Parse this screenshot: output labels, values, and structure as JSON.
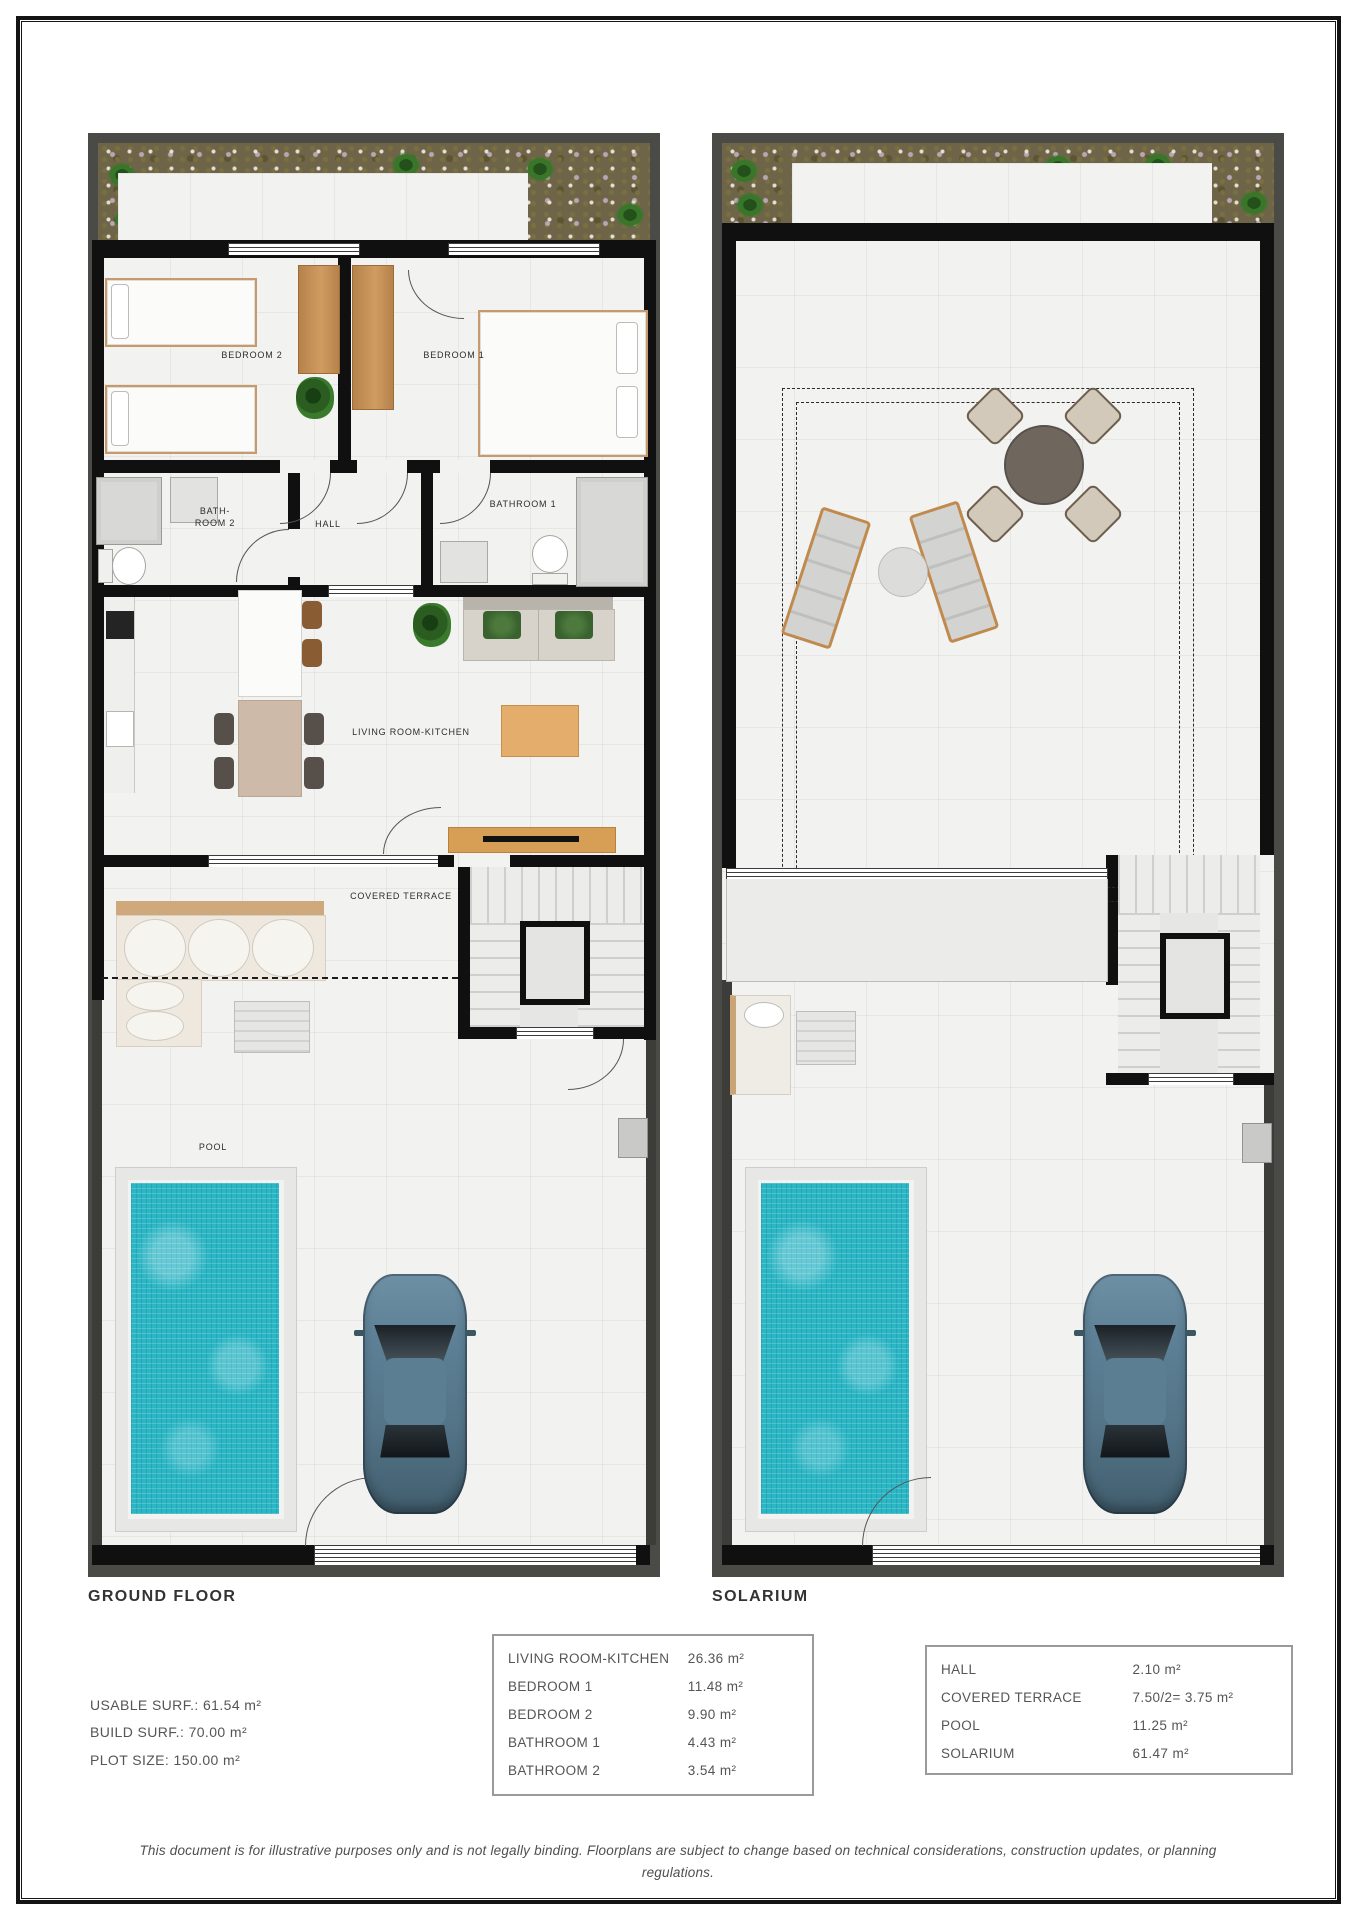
{
  "document": {
    "disclaimer": "This document is for illustrative purposes only and is not legally binding. Floorplans are subject to change based on technical considerations, construction updates, or planning regulations."
  },
  "plans": {
    "ground_floor": {
      "title": "GROUND FLOOR",
      "labels": {
        "bedroom2": "BEDROOM 2",
        "bedroom1": "BEDROOM 1",
        "bathroom2": "BATH-\nROOM 2",
        "hall": "HALL",
        "bathroom1": "BATHROOM 1",
        "living": "LIVING ROOM-KITCHEN",
        "terrace": "COVERED TERRACE",
        "pool": "POOL"
      }
    },
    "solarium": {
      "title": "SOLARIUM"
    }
  },
  "surface_summary": {
    "rows": [
      {
        "label": "USABLE SURF.:",
        "value": "61.54 m²"
      },
      {
        "label": "BUILD SURF.:",
        "value": "70.00 m²"
      },
      {
        "label": "PLOT SIZE:",
        "value": "150.00 m²"
      }
    ]
  },
  "room_areas_table": {
    "rows": [
      {
        "name": "LIVING ROOM-KITCHEN",
        "value": "26.36 m²"
      },
      {
        "name": "BEDROOM 1",
        "value": "11.48 m²"
      },
      {
        "name": "BEDROOM 2",
        "value": "9.90 m²"
      },
      {
        "name": "BATHROOM 1",
        "value": "4.43 m²"
      },
      {
        "name": "BATHROOM 2",
        "value": "3.54 m²"
      }
    ]
  },
  "exterior_areas_table": {
    "rows": [
      {
        "name": "HALL",
        "value": "2.10 m²"
      },
      {
        "name": "COVERED TERRACE",
        "value": "7.50/2= 3.75 m²"
      },
      {
        "name": "POOL",
        "value": "11.25 m²"
      },
      {
        "name": "SOLARIUM",
        "value": "61.47 m²"
      }
    ]
  },
  "colors": {
    "pool_water": "#2ab6c5",
    "wall": "#101010",
    "plot_frame": "#4a4a46",
    "wood": "#bf8a52",
    "page_border": "#141414"
  }
}
